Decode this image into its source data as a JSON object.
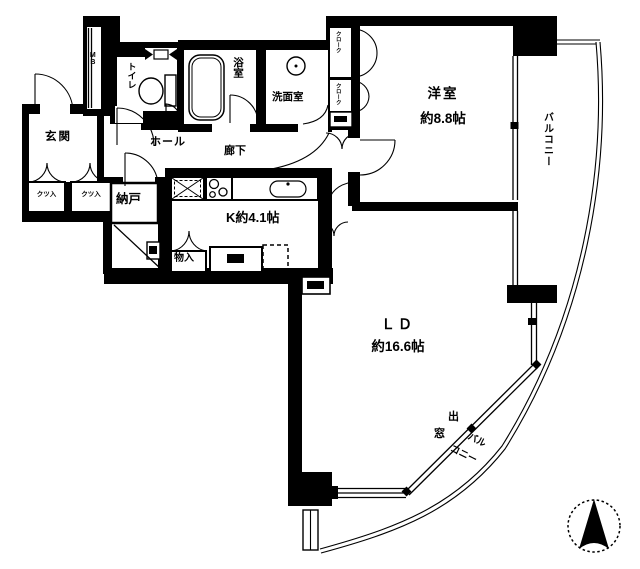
{
  "plan": {
    "type": "apartment-floor-plan",
    "colors": {
      "wall": "#000000",
      "background": "#ffffff"
    },
    "labels": {
      "bedroom": "洋室",
      "bedroom_size": "約8.8帖",
      "living_dining": "ＬＤ",
      "living_dining_size": "約16.6帖",
      "kitchen": "K約4.1帖",
      "entrance": "玄関",
      "hall": "ホール",
      "corridor": "廊下",
      "storage_room": "納戸",
      "toilet": "トイレ",
      "bathroom": "浴室",
      "washroom": "洗面室",
      "closet": "物入",
      "shoe_box_left": "クツ入",
      "shoe_box_right": "クツ入",
      "cloak_upper": "クローク",
      "cloak_lower": "クローク",
      "meter_box": "MB",
      "balcony_side": "バルコニー",
      "bay_window_char1": "出",
      "bay_window_char2": "窓",
      "balcony_bottom_part1": "バル",
      "balcony_bottom_part2": "コニー"
    },
    "compass": {
      "direction": "north",
      "style": "dotted-circle-black-arrow"
    }
  }
}
